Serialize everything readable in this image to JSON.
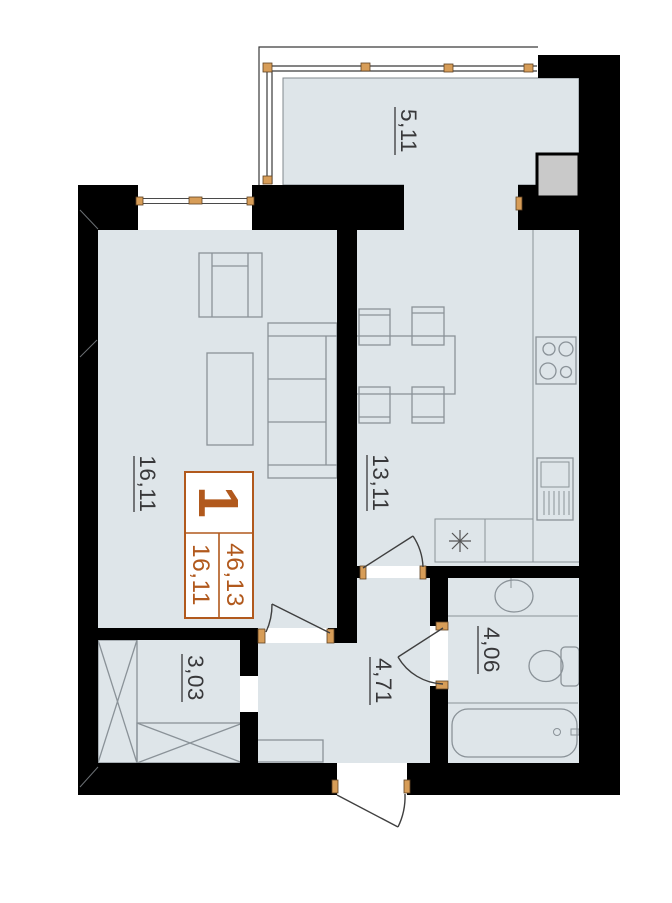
{
  "unit_card": {
    "rooms_count": "1",
    "total_area": "46,13",
    "living_area": "16,11"
  },
  "room_areas": {
    "balcony": "5,11",
    "living_room": "16,11",
    "kitchen": "13,11",
    "wardrobe": "3,03",
    "hallway": "4,71",
    "bathroom": "4,06"
  },
  "colors": {
    "accent": "#b1591d",
    "floor": "#dee5e9",
    "wall": "#000000",
    "label": "#38383a"
  }
}
